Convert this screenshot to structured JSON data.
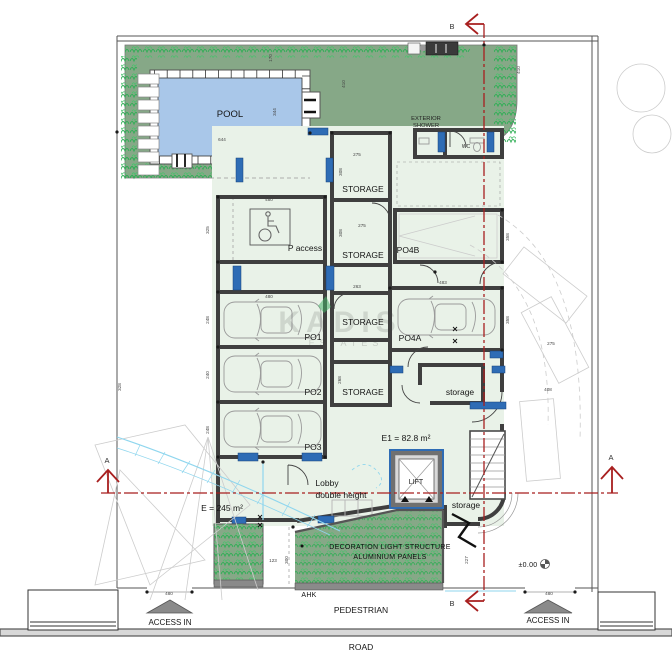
{
  "plan": {
    "watermark": {
      "line1": "KADIS",
      "line2": "ESTATES"
    },
    "labels": {
      "pool": "POOL",
      "exterior_shower_line1": "EXTERIOR",
      "exterior_shower_line2": "SHOWER",
      "wc": "WC",
      "storage_caps": "STORAGE",
      "storage_lower": "storage",
      "p_access": "P access",
      "po1": "PO1",
      "po2": "PO2",
      "po3": "PO3",
      "po4a": "PO4A",
      "po4b": "PO4B",
      "lift": "LIFT",
      "lobby_line1": "Lobby",
      "lobby_line2": "double height",
      "e1_area": "E1 = 82.8 m²",
      "e_area": "E = 245 m²",
      "decoration_line1": "DECORATION LIGHT STRUCTURE",
      "decoration_line2": "ALUMINIUM PANELS",
      "ahk": "AHK",
      "pedestrian": "PEDESTRIAN",
      "road": "ROAD",
      "access_in": "ACCESS IN",
      "level": "±0.00",
      "section_a": "A",
      "section_b": "B"
    },
    "colors": {
      "garden_green": "#86a887",
      "vegetation_green": "#2fae55",
      "pool_blue": "#a9c7e9",
      "interior_green": "#e9f2e8",
      "frame_blue": "#2e6cb5",
      "section_red": "#a81f1f",
      "wall_gray": "#3f3f3f"
    },
    "dimensions": [
      {
        "v": "170",
        "x": 272,
        "y": 58,
        "rot": 1
      },
      {
        "v": "410",
        "x": 345,
        "y": 84,
        "rot": 1
      },
      {
        "v": "410",
        "x": 520,
        "y": 70,
        "rot": 1
      },
      {
        "v": "344",
        "x": 276,
        "y": 112,
        "rot": 1
      },
      {
        "v": "644",
        "x": 222,
        "y": 141,
        "rot": 0
      },
      {
        "v": "275",
        "x": 357,
        "y": 156,
        "rot": 0
      },
      {
        "v": "308",
        "x": 342,
        "y": 172,
        "rot": 1
      },
      {
        "v": "480",
        "x": 269,
        "y": 201,
        "rot": 0
      },
      {
        "v": "325",
        "x": 209,
        "y": 230,
        "rot": 1
      },
      {
        "v": "275",
        "x": 362,
        "y": 227,
        "rot": 0
      },
      {
        "v": "308",
        "x": 342,
        "y": 233,
        "rot": 1
      },
      {
        "v": "483",
        "x": 443,
        "y": 284,
        "rot": 0
      },
      {
        "v": "358",
        "x": 509,
        "y": 237,
        "rot": 1
      },
      {
        "v": "263",
        "x": 357,
        "y": 288,
        "rot": 0
      },
      {
        "v": "480",
        "x": 269,
        "y": 298,
        "rot": 0
      },
      {
        "v": "248",
        "x": 209,
        "y": 320,
        "rot": 1
      },
      {
        "v": "240",
        "x": 209,
        "y": 375,
        "rot": 1
      },
      {
        "v": "248",
        "x": 209,
        "y": 430,
        "rot": 1
      },
      {
        "v": "358",
        "x": 509,
        "y": 320,
        "rot": 1
      },
      {
        "v": "328",
        "x": 121,
        "y": 387,
        "rot": 1
      },
      {
        "v": "268",
        "x": 341,
        "y": 380,
        "rot": 1
      },
      {
        "v": "275",
        "x": 551,
        "y": 345,
        "rot": 0
      },
      {
        "v": "408",
        "x": 548,
        "y": 391,
        "rot": 0
      },
      {
        "v": "123",
        "x": 273,
        "y": 562,
        "rot": 0
      },
      {
        "v": "300",
        "x": 288,
        "y": 560,
        "rot": 1
      },
      {
        "v": "227",
        "x": 468,
        "y": 560,
        "rot": 1
      },
      {
        "v": "480",
        "x": 169,
        "y": 595,
        "rot": 0
      },
      {
        "v": "480",
        "x": 549,
        "y": 595,
        "rot": 0
      }
    ]
  }
}
